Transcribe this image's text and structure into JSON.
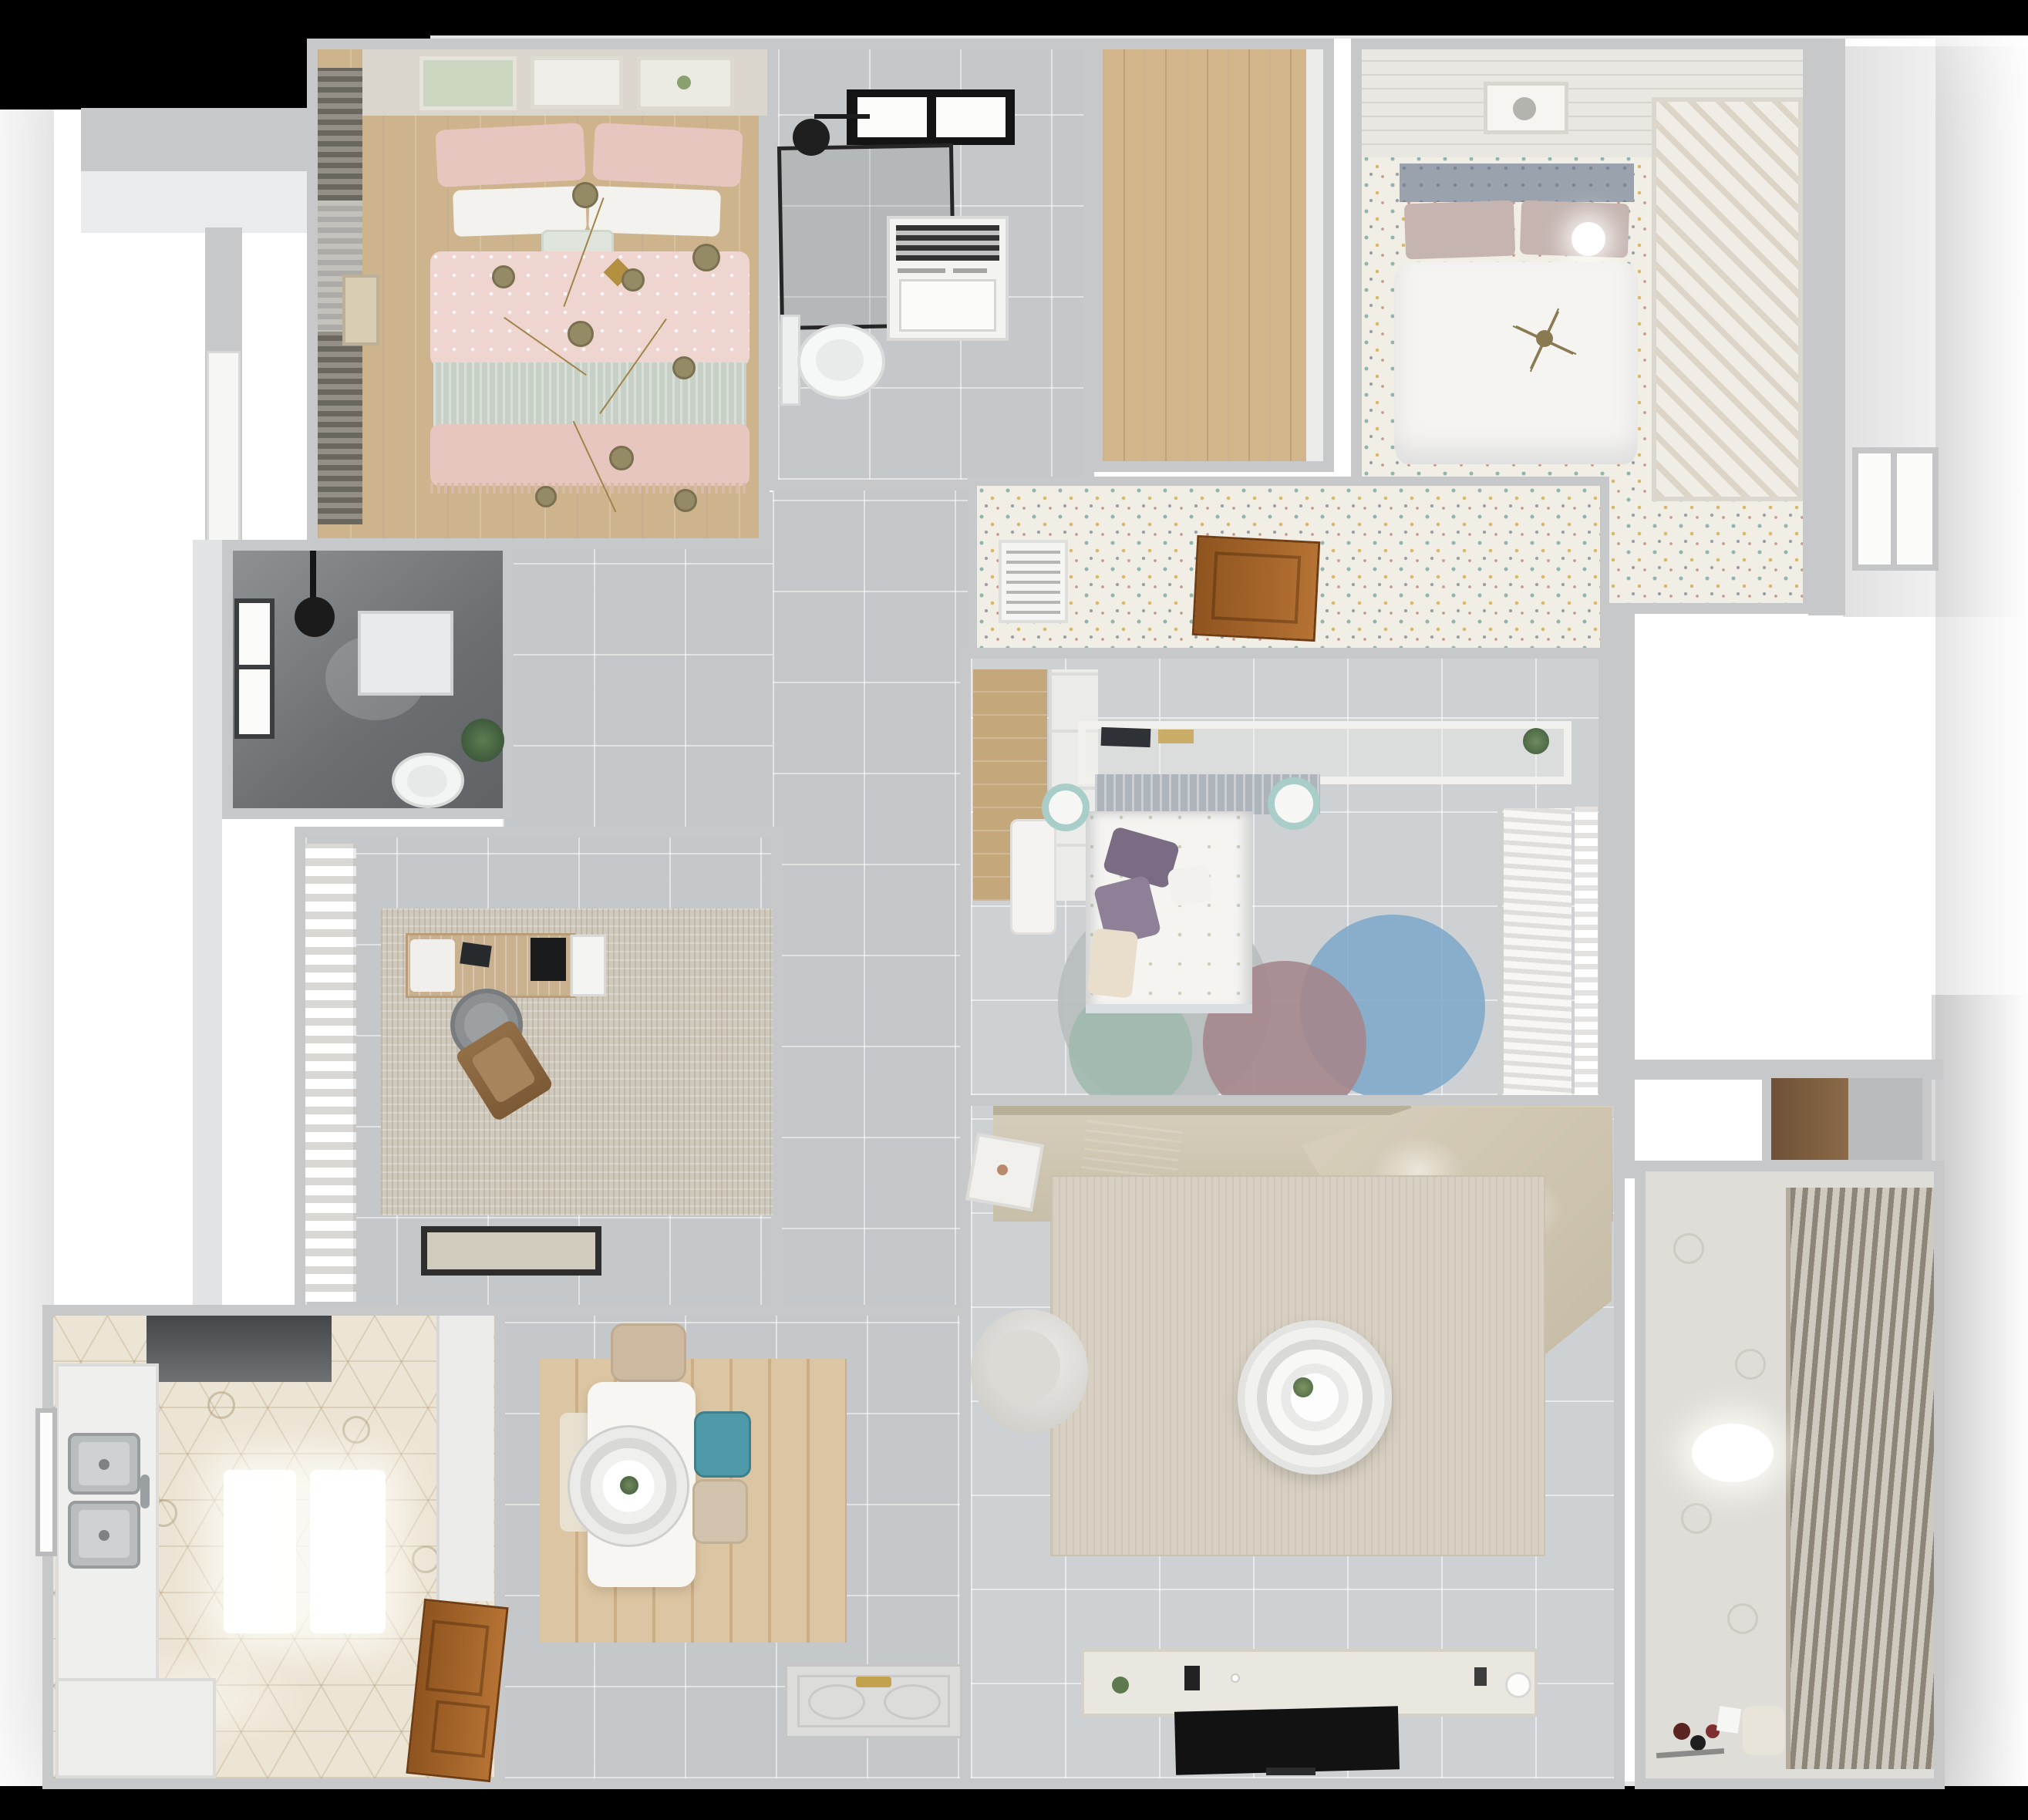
{
  "title": "3D rendered apartment floor plan (top-down view)",
  "palette": {
    "canvas": "#ffffff",
    "frame": "#000000",
    "wall": "#c6c8ca",
    "wallface": "#eaebec",
    "tile": "#c5c8ca",
    "tileL": "#ced1d3",
    "speckle": "#f1eee6",
    "wood": "#cdb48c",
    "oak": "#d2b58b",
    "hex": "#ece4d4",
    "dark1": "#8d9193",
    "dark2": "#5f6365",
    "pink": "#eed5d0",
    "pink2": "#e7c6c0",
    "sage": "#c6d0c5",
    "softwhite": "#f5f4f1",
    "slate": "#9aa2ae",
    "mauve": "#c5b4b0",
    "purple": "#7a6c82",
    "tan": "#d0c6b3",
    "throw": "#696b6a",
    "teal": "#4f9aa8",
    "tealsoft": "#a9cdc9",
    "gold": "#b29040",
    "olive": "#958a66",
    "doorwood": "#9a5c28",
    "tv": "#121212",
    "blind": "#8d8577",
    "curtain": "#f1f1f0",
    "green": "#46603f",
    "rugliving": "#d8d1c3",
    "rugstudy": "#cfc9bc",
    "plank": "#dcc5a2",
    "cgray": "#b9bdbd",
    "cblue": "#80a9ca",
    "cmauve": "#a5868c",
    "cteal": "#9db8ac",
    "mat": "#dcdcda"
  },
  "rooms": [
    {
      "id": "master-bedroom",
      "name": "Master bedroom",
      "floor": "wood planks",
      "items": [
        "window blinds",
        "three art frames",
        "double bed with pink patterned duvet",
        "white and pink pillows",
        "sage throw band",
        "gold branch chandelier"
      ]
    },
    {
      "id": "bathroom",
      "name": "Bathroom",
      "floor": "gray tile",
      "items": [
        "black skylight",
        "black framed shower enclosure",
        "shower head",
        "washing machine",
        "wall-hung toilet"
      ]
    },
    {
      "id": "wardrobe-hall",
      "name": "Wardrobe hallway",
      "floor": "oak planks",
      "items": []
    },
    {
      "id": "bedroom-2",
      "name": "Bedroom 2",
      "floor": "floral speckle carpet",
      "items": [
        "paneled wall with art frame",
        "tufted slate headboard",
        "mauve pillows",
        "white duvet",
        "glowing bedside lamp",
        "branch chandelier",
        "slatted shelving unit"
      ]
    },
    {
      "id": "corridor",
      "name": "Corridor",
      "floor": "floral speckle carpet",
      "items": [
        "air vent grille",
        "open wood door leaf"
      ]
    },
    {
      "id": "shower-room",
      "name": "Shower room",
      "floor": "dark gray tile",
      "items": [
        "window",
        "black shower head",
        "shower tray",
        "toilet",
        "plant"
      ]
    },
    {
      "id": "study",
      "name": "Study",
      "floor": "gray tile",
      "items": [
        "white curtains",
        "distressed rug",
        "wood desk",
        "monitor",
        "desk chair",
        "brown lounge chair",
        "dark door mat"
      ]
    },
    {
      "id": "bedroom-3",
      "name": "Bedroom 3",
      "floor": "light tile",
      "items": [
        "wood nook",
        "wardrobe front",
        "bridging head shelf with books and plant",
        "pleated headboard",
        "bed with floral duvet",
        "purple pillows",
        "two teal nightstands",
        "white desk",
        "overlapping circle rug",
        "hanging clothes",
        "sheer curtain"
      ]
    },
    {
      "id": "living-room",
      "name": "Living room",
      "floor": "light tile",
      "items": [
        "sectional sofa with chaise",
        "gray throw blanket",
        "beige area rug",
        "round ring coffee table",
        "armchair",
        "side table",
        "media console",
        "flat tv"
      ]
    },
    {
      "id": "dining-room",
      "name": "Dining / entry",
      "floor": "gray tile",
      "items": [
        "plank rug",
        "white dining table",
        "ring pendant lamp",
        "beige chair",
        "teal chair",
        "beige chair",
        "bench",
        "entry door leaf with gold handles"
      ]
    },
    {
      "id": "kitchen",
      "name": "Kitchen",
      "floor": "hex mosaic tile",
      "items": [
        "range hood",
        "left counter with double sink",
        "faucet",
        "window",
        "bottom counter",
        "two glowing ceiling lights",
        "tall cabinet",
        "open wood entry door"
      ]
    },
    {
      "id": "balcony",
      "name": "Balcony / laundry",
      "floor": "patterned tile",
      "items": [
        "slatted blinds",
        "glowing ceiling lamp",
        "stool",
        "toys"
      ]
    },
    {
      "id": "storage-niche",
      "name": "Storage niche",
      "floor": "wood",
      "items": []
    }
  ]
}
